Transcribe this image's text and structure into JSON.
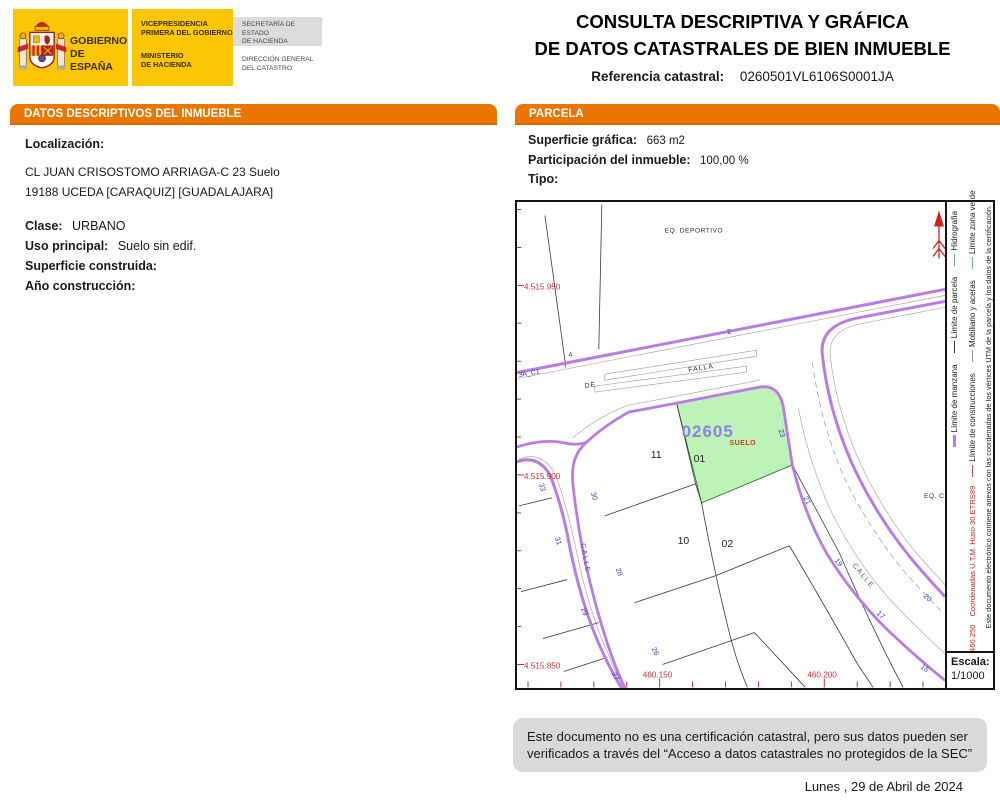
{
  "header": {
    "logo": {
      "gobierno_line1": "GOBIERNO",
      "gobierno_line2": "DE ESPAÑA",
      "vice_line1": "VICEPRESIDENCIA",
      "vice_line2": "PRIMERA DEL GOBIERNO",
      "ministerio_line1": "MINISTERIO",
      "ministerio_line2": "DE HACIENDA",
      "secretaria_line1": "SECRETARÍA DE ESTADO",
      "secretaria_line2": "DE HACIENDA",
      "direccion_line1": "DIRECCIÓN GENERAL",
      "direccion_line2": "DEL CATASTRO"
    },
    "title_line1": "CONSULTA DESCRIPTIVA Y GRÁFICA",
    "title_line2": "DE DATOS CATASTRALES DE BIEN INMUEBLE",
    "ref_label": "Referencia catastral:",
    "ref_value": "0260501VL6106S0001JA"
  },
  "left_panel": {
    "title": "DATOS DESCRIPTIVOS DEL INMUEBLE",
    "localizacion_label": "Localización:",
    "address_line1": "CL JUAN CRISOSTOMO ARRIAGA-C 23 Suelo",
    "address_line2": "19188 UCEDA [CARAQUIZ] [GUADALAJARA]",
    "clase_label": "Clase:",
    "clase_value": "URBANO",
    "uso_label": "Uso principal:",
    "uso_value": "Suelo sin edif.",
    "superficie_label": "Superficie construida:",
    "anio_label": "Año construcción:"
  },
  "parcel_panel": {
    "title": "PARCELA",
    "superficie_label": "Superficie gráfica:",
    "superficie_value": "663 m2",
    "participacion_label": "Participación del inmueble:",
    "participacion_value": "100,00 %",
    "tipo_label": "Tipo:"
  },
  "map": {
    "eq_deportivo": "EQ. DEPORTIVO",
    "eq_c": "EQ. C",
    "street_de": "DE",
    "street_falla": "FALLA",
    "calle_left": "CALLE",
    "calle_right": "CALLE",
    "corner_ref": "3A_C1",
    "parcel_code": "02605",
    "parcel_use": "SUELO",
    "parcel_sub": "01",
    "p11": "11",
    "p10": "10",
    "p02": "02",
    "n4": "4",
    "n2": "2",
    "n33": "33",
    "n31": "31",
    "n29": "29",
    "n27": "27",
    "n30": "30",
    "n28": "28",
    "n26": "26",
    "n23": "23",
    "n21": "21",
    "n19": "19",
    "n17": "17",
    "n15": "15",
    "n20": "20",
    "coord_y1": "4.515.950",
    "coord_y2": "4.515.900",
    "coord_y3": "4.515.850",
    "coord_x1": "460.150",
    "coord_x2": "460.200",
    "highlight_fill": "#BDF3B6",
    "road_color": "#B97CE6",
    "coord_color": "#CD3333",
    "number_color": "#3A3ACB"
  },
  "sidebar": {
    "legend": {
      "manzana": {
        "label": "Límite de manzana",
        "color": "#BB7DE8"
      },
      "construcciones": {
        "label": "Límite de construcciones",
        "color": "#CC4444"
      },
      "parcela": {
        "label": "Límite de parcela",
        "color": "#333333"
      },
      "mobiliario": {
        "label": "Mobiliario y aceras",
        "color": "#999999"
      },
      "hidrografia": {
        "label": "Hidrografía",
        "color": "#7A9AD0"
      },
      "zona_verde": {
        "label": "Límite zona verde",
        "color": "#7CBF7C"
      }
    },
    "coord_x3": "460.250",
    "utm_note": "Coordenadas U.T.M. Huso 30 ETRS89",
    "annex_note": "Este documento electrónico contiene anexos con las coordenadas de los vértices UTM de la parcela y los datos de la certificación.",
    "escala_label": "Escala:",
    "escala_value": "1/1000"
  },
  "footer": {
    "disclaimer": "Este documento no es una certificación catastral, pero sus datos pueden ser verificados a través del “Acceso a datos catastrales no protegidos de la SEC”",
    "date": "Lunes , 29 de Abril de 2024"
  },
  "colors": {
    "section_bar": "#EA7600",
    "logo_yellow": "#FDC605",
    "footer_gray": "#D9D9D9"
  }
}
